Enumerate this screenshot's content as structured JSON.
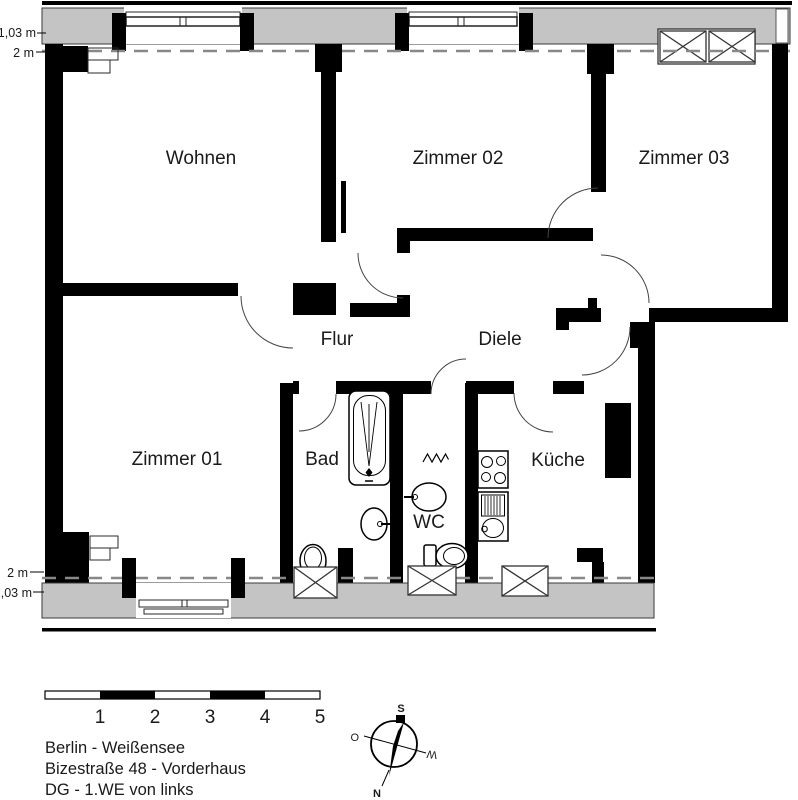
{
  "plan": {
    "room_labels": {
      "wohnen": "Wohnen",
      "zimmer02": "Zimmer 02",
      "zimmer03": "Zimmer 03",
      "zimmer01": "Zimmer 01",
      "flur": "Flur",
      "diele": "Diele",
      "bad": "Bad",
      "wc": "WC",
      "kueche": "Küche"
    },
    "height_lines": {
      "top_upper": "1,03 m",
      "top_lower": "2 m",
      "bottom_upper": "2 m",
      "bottom_lower": "1,03 m"
    }
  },
  "scale_bar": {
    "labels": [
      "1",
      "2",
      "3",
      "4",
      "5"
    ]
  },
  "compass": {
    "south": "S",
    "north": "N",
    "east": "O",
    "west": "W"
  },
  "address": {
    "line1": "Berlin - Weißensee",
    "line2": "Bizestraße 48 - Vorderhaus",
    "line3": "DG - 1.WE von links"
  },
  "colors": {
    "wall": "#000000",
    "roof_band": "#c4c4c4",
    "dashed_line": "#888888"
  }
}
